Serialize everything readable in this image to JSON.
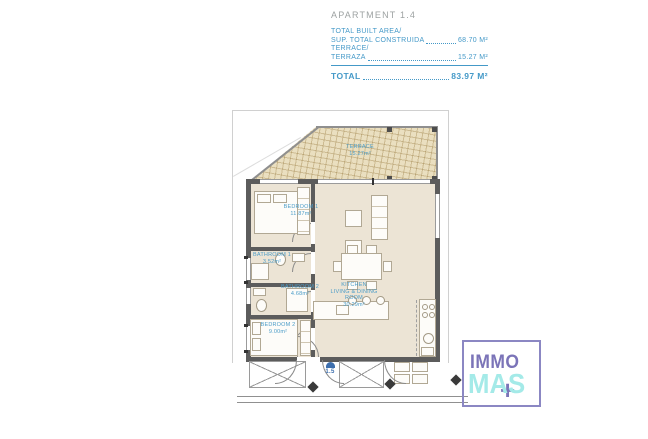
{
  "title": {
    "apartment": "APARTMENT 1.4"
  },
  "summary": {
    "rows": [
      {
        "line1": "TOTAL BUILT AREA/",
        "line2": "SUP. TOTAL CONSTRUIDA",
        "value": "68.70 M²"
      },
      {
        "line1": "TERRACE/",
        "line2": "TERRAZA",
        "value": "15.27 M²"
      }
    ],
    "total": {
      "label": "TOTAL",
      "value": "83.97 M²"
    }
  },
  "plan": {
    "terrace": {
      "name": "TERRACE",
      "area": "15.27m²"
    },
    "rooms": [
      {
        "name": "BEDROOM 1",
        "area": "11.87m²"
      },
      {
        "name": "BATHROOM 1",
        "area": "3.52m²"
      },
      {
        "name": "BATHROOM 2",
        "area": "4.68m²"
      },
      {
        "name": "BEDROOM 2",
        "area": "9.00m²"
      },
      {
        "name": "KITCHEN",
        "subname": "LIVING & DINING ROOM",
        "area": "30.29m²"
      }
    ],
    "entrance": {
      "label": "1.5"
    }
  },
  "logo": {
    "immo": "IMMO",
    "mas": "MAS",
    "plus": "+"
  },
  "colors": {
    "accent_blue": "#4499c8",
    "label_blue": "#4a9cc8",
    "title_gray": "#9da2a2",
    "terrace_fill": "#eadfc0",
    "floor_fill": "#ece4d5",
    "wall_gray": "#5c5c5c",
    "logo_purple": "#7b74b8",
    "logo_cyan": "#a4eae8"
  }
}
